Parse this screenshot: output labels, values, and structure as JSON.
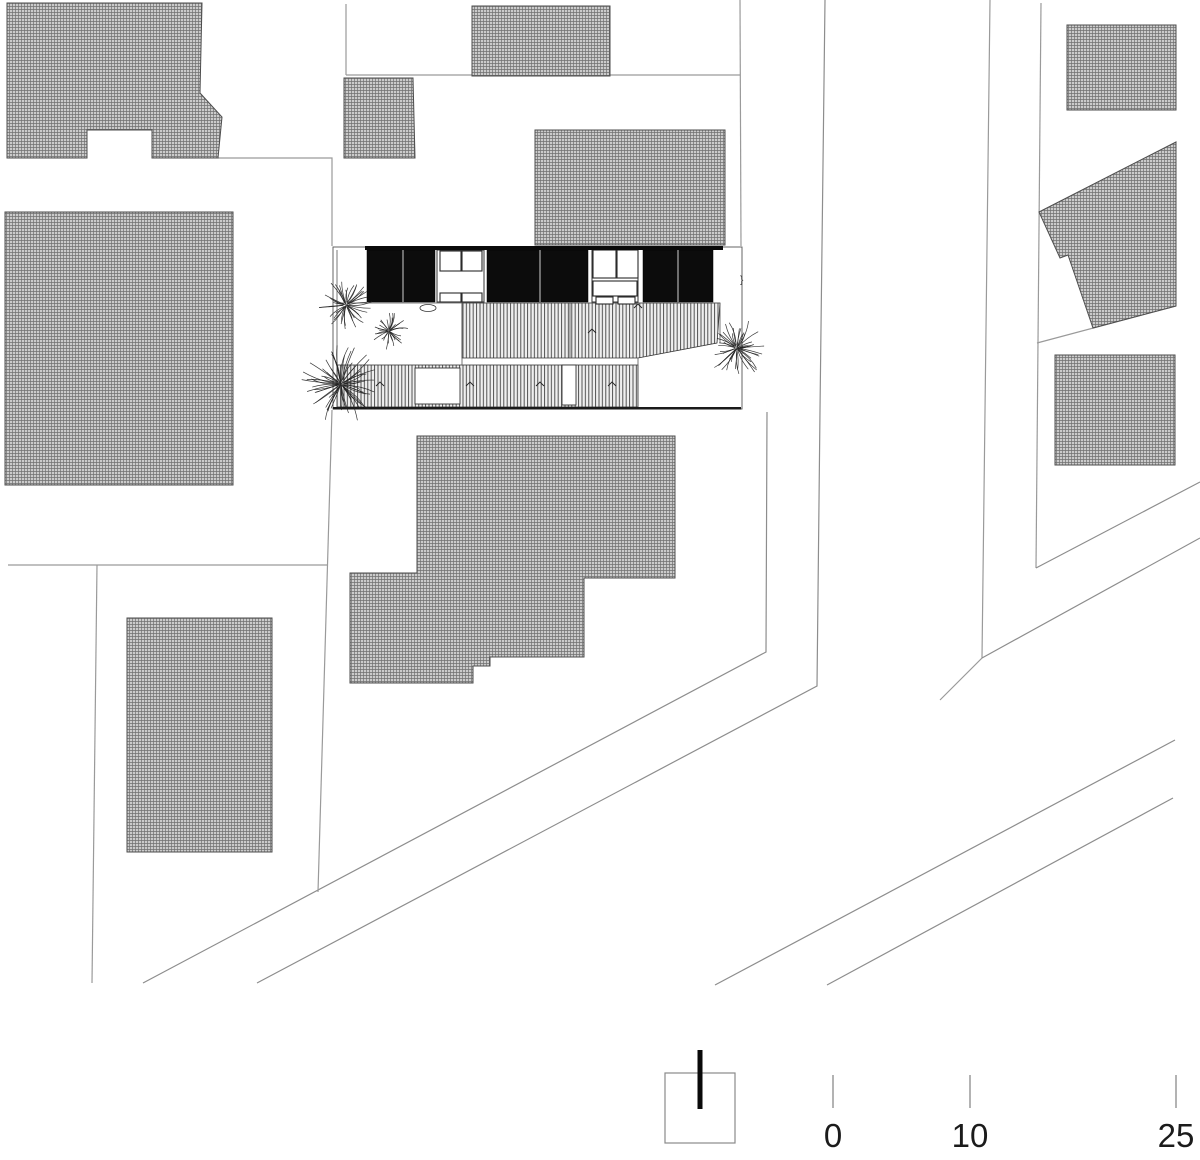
{
  "drawing": {
    "type": "architectural-site-plan",
    "units_note": "meters",
    "colors": {
      "background": "#ffffff",
      "parcel_line": "#9a9a9a",
      "road_line": "#8d8d8d",
      "building_outline": "#4d4d4d",
      "hatch_fill": "#cbcbcb",
      "hatch_line": "#707070",
      "stripe_fill": "#efefef",
      "stripe_line": "#404040",
      "panel_black": "#0c0c0c",
      "plot_stroke": "#555555",
      "tree_line": "#222222",
      "label_text": "#1b1b1b"
    }
  },
  "plan": {
    "hatched_buildings": [
      {
        "name": "neighbor-building-top-left",
        "points": [
          [
            7,
            3
          ],
          [
            202,
            3
          ],
          [
            200,
            93
          ],
          [
            222,
            117
          ],
          [
            218,
            158
          ],
          [
            152,
            158
          ],
          [
            152,
            130
          ],
          [
            87,
            130
          ],
          [
            87,
            158
          ],
          [
            7,
            158
          ]
        ]
      },
      {
        "name": "neighbor-building-left",
        "points": [
          [
            5,
            212
          ],
          [
            233,
            212
          ],
          [
            233,
            485
          ],
          [
            5,
            485
          ]
        ]
      },
      {
        "name": "neighbor-building-bottom-left",
        "points": [
          [
            127,
            618
          ],
          [
            272,
            618
          ],
          [
            272,
            852
          ],
          [
            127,
            852
          ]
        ]
      },
      {
        "name": "neighbor-building-mid-small",
        "points": [
          [
            344,
            78
          ],
          [
            413,
            78
          ],
          [
            415,
            158
          ],
          [
            344,
            158
          ]
        ]
      },
      {
        "name": "neighbor-building-top-middle",
        "points": [
          [
            472,
            6
          ],
          [
            610,
            6
          ],
          [
            610,
            76
          ],
          [
            472,
            76
          ]
        ]
      },
      {
        "name": "neighbor-building-middle",
        "points": [
          [
            535,
            130
          ],
          [
            725,
            130
          ],
          [
            725,
            245
          ],
          [
            535,
            245
          ]
        ]
      },
      {
        "name": "neighbor-building-center-south",
        "points": [
          [
            417,
            436
          ],
          [
            675,
            436
          ],
          [
            675,
            578
          ],
          [
            584,
            578
          ],
          [
            584,
            657
          ],
          [
            490,
            657
          ],
          [
            490,
            666
          ],
          [
            473,
            666
          ],
          [
            473,
            683
          ],
          [
            350,
            683
          ],
          [
            350,
            573
          ],
          [
            417,
            573
          ]
        ]
      },
      {
        "name": "neighbor-building-top-right",
        "points": [
          [
            1067,
            25
          ],
          [
            1176,
            25
          ],
          [
            1176,
            110
          ],
          [
            1067,
            110
          ]
        ]
      },
      {
        "name": "neighbor-building-right-angled",
        "points": [
          [
            1039,
            212
          ],
          [
            1176,
            142
          ],
          [
            1176,
            306
          ],
          [
            1093,
            328
          ],
          [
            1068,
            255
          ],
          [
            1060,
            258
          ]
        ]
      },
      {
        "name": "neighbor-building-right-lower",
        "points": [
          [
            1055,
            355
          ],
          [
            1175,
            355
          ],
          [
            1175,
            465
          ],
          [
            1055,
            465
          ]
        ]
      }
    ],
    "parcel_lines": [
      {
        "name": "parcel-line",
        "points": [
          [
            346,
            4
          ],
          [
            346,
            75
          ]
        ]
      },
      {
        "name": "parcel-line",
        "points": [
          [
            346,
            75
          ],
          [
            740,
            75
          ]
        ]
      },
      {
        "name": "parcel-line",
        "points": [
          [
            740,
            0
          ],
          [
            741,
            246
          ]
        ]
      },
      {
        "name": "parcel-line-road-east",
        "points": [
          [
            825,
            0
          ],
          [
            820,
            410
          ],
          [
            817,
            686
          ],
          [
            257,
            983
          ]
        ]
      },
      {
        "name": "parcel-line-road-west",
        "points": [
          [
            767,
            412
          ],
          [
            766,
            652
          ],
          [
            143,
            983
          ]
        ]
      },
      {
        "name": "parcel-line",
        "points": [
          [
            218,
            158
          ],
          [
            332,
            158
          ],
          [
            332,
            246
          ]
        ]
      },
      {
        "name": "parcel-line",
        "points": [
          [
            8,
            565
          ],
          [
            327,
            565
          ]
        ]
      },
      {
        "name": "parcel-line",
        "points": [
          [
            97,
            565
          ],
          [
            92,
            983
          ]
        ]
      },
      {
        "name": "parcel-line",
        "points": [
          [
            332,
            410
          ],
          [
            318,
            892
          ]
        ]
      },
      {
        "name": "parcel-line",
        "points": [
          [
            990,
            0
          ],
          [
            982,
            658
          ],
          [
            940,
            700
          ]
        ]
      },
      {
        "name": "parcel-line",
        "points": [
          [
            1041,
            3
          ],
          [
            1036,
            568
          ]
        ]
      },
      {
        "name": "road-line",
        "points": [
          [
            1200,
            482
          ],
          [
            1036,
            568
          ]
        ]
      },
      {
        "name": "road-line",
        "points": [
          [
            1200,
            538
          ],
          [
            982,
            658
          ]
        ]
      },
      {
        "name": "parcel-line",
        "points": [
          [
            1037,
            343
          ],
          [
            1176,
            306
          ]
        ]
      },
      {
        "name": "road-line",
        "points": [
          [
            715,
            985
          ],
          [
            1175,
            740
          ]
        ]
      },
      {
        "name": "road-line",
        "points": [
          [
            827,
            985
          ],
          [
            1173,
            798
          ]
        ]
      }
    ],
    "main_building": {
      "plot": {
        "x": 333,
        "y": 247,
        "w": 409,
        "h": 162
      },
      "top_edge": {
        "x": 365,
        "y": 246,
        "w": 358,
        "h": 4
      },
      "bottom_edge": {
        "x": 333,
        "y": 407,
        "w": 408,
        "h": 2.5
      },
      "panels": {
        "y": 250,
        "h": 52,
        "items": [
          {
            "x": 367,
            "w": 68,
            "divider": 403
          },
          {
            "x": 487,
            "w": 101,
            "divider": 540
          },
          {
            "x": 643,
            "w": 70,
            "divider": 678
          }
        ]
      },
      "rooms": [
        {
          "x": 437,
          "w": 47,
          "cells": [
            [
              440,
              251,
              21,
              20
            ],
            [
              462,
              251,
              20,
              20
            ],
            [
              440,
              293,
              21,
              9
            ],
            [
              462,
              293,
              20,
              9
            ]
          ]
        },
        {
          "x": 592,
          "w": 46,
          "cells": [
            [
              593,
              250,
              23,
              28
            ],
            [
              617,
              250,
              21,
              28
            ],
            [
              593,
              281,
              44,
              15
            ],
            [
              596,
              297,
              17,
              7
            ],
            [
              618,
              297,
              17,
              7
            ]
          ]
        }
      ],
      "deck_points": [
        [
          462,
          303
        ],
        [
          720,
          303
        ],
        [
          717,
          343
        ],
        [
          638,
          358
        ],
        [
          462,
          358
        ]
      ],
      "strip": {
        "x": 337,
        "y": 365,
        "w": 301,
        "h": 42
      },
      "openings": [
        [
          415,
          368,
          45,
          36
        ],
        [
          562,
          365,
          14,
          40
        ]
      ],
      "inner_lines": [
        [
          337,
          250,
          337,
          407
        ],
        [
          462,
          303,
          462,
          365
        ],
        [
          570,
          303,
          570,
          358
        ],
        [
          638,
          358,
          638,
          407
        ],
        [
          720,
          303,
          720,
          343
        ],
        [
          337,
          303,
          720,
          303
        ]
      ],
      "chevrons": [
        [
          592,
          331
        ],
        [
          638,
          306
        ],
        [
          380,
          384
        ],
        [
          470,
          384
        ],
        [
          540,
          384
        ],
        [
          612,
          384
        ]
      ],
      "door_ellipse": {
        "cx": 428,
        "cy": 308,
        "rx": 8,
        "ry": 3.5
      },
      "brace_mark": {
        "x": 740,
        "y": 283,
        "glyph": "}"
      }
    },
    "trees": [
      {
        "cx": 346,
        "cy": 305,
        "r": 28,
        "seed": 3
      },
      {
        "cx": 389,
        "cy": 331,
        "r": 20,
        "seed": 7
      },
      {
        "cx": 341,
        "cy": 384,
        "r": 40,
        "seed": 11
      },
      {
        "cx": 737,
        "cy": 348,
        "r": 30,
        "seed": 19
      }
    ]
  },
  "scale_bar": {
    "square": {
      "x": 665,
      "y": 1073,
      "w": 70,
      "h": 70
    },
    "north_line": {
      "x": 700,
      "y1": 1050,
      "y2": 1109,
      "width": 5
    },
    "tick_y1": 1075,
    "tick_y2": 1108,
    "label_top": 1119,
    "ticks": [
      {
        "x": 833,
        "label": "0"
      },
      {
        "x": 970,
        "label": "10"
      },
      {
        "x": 1176,
        "label": "25"
      }
    ]
  }
}
